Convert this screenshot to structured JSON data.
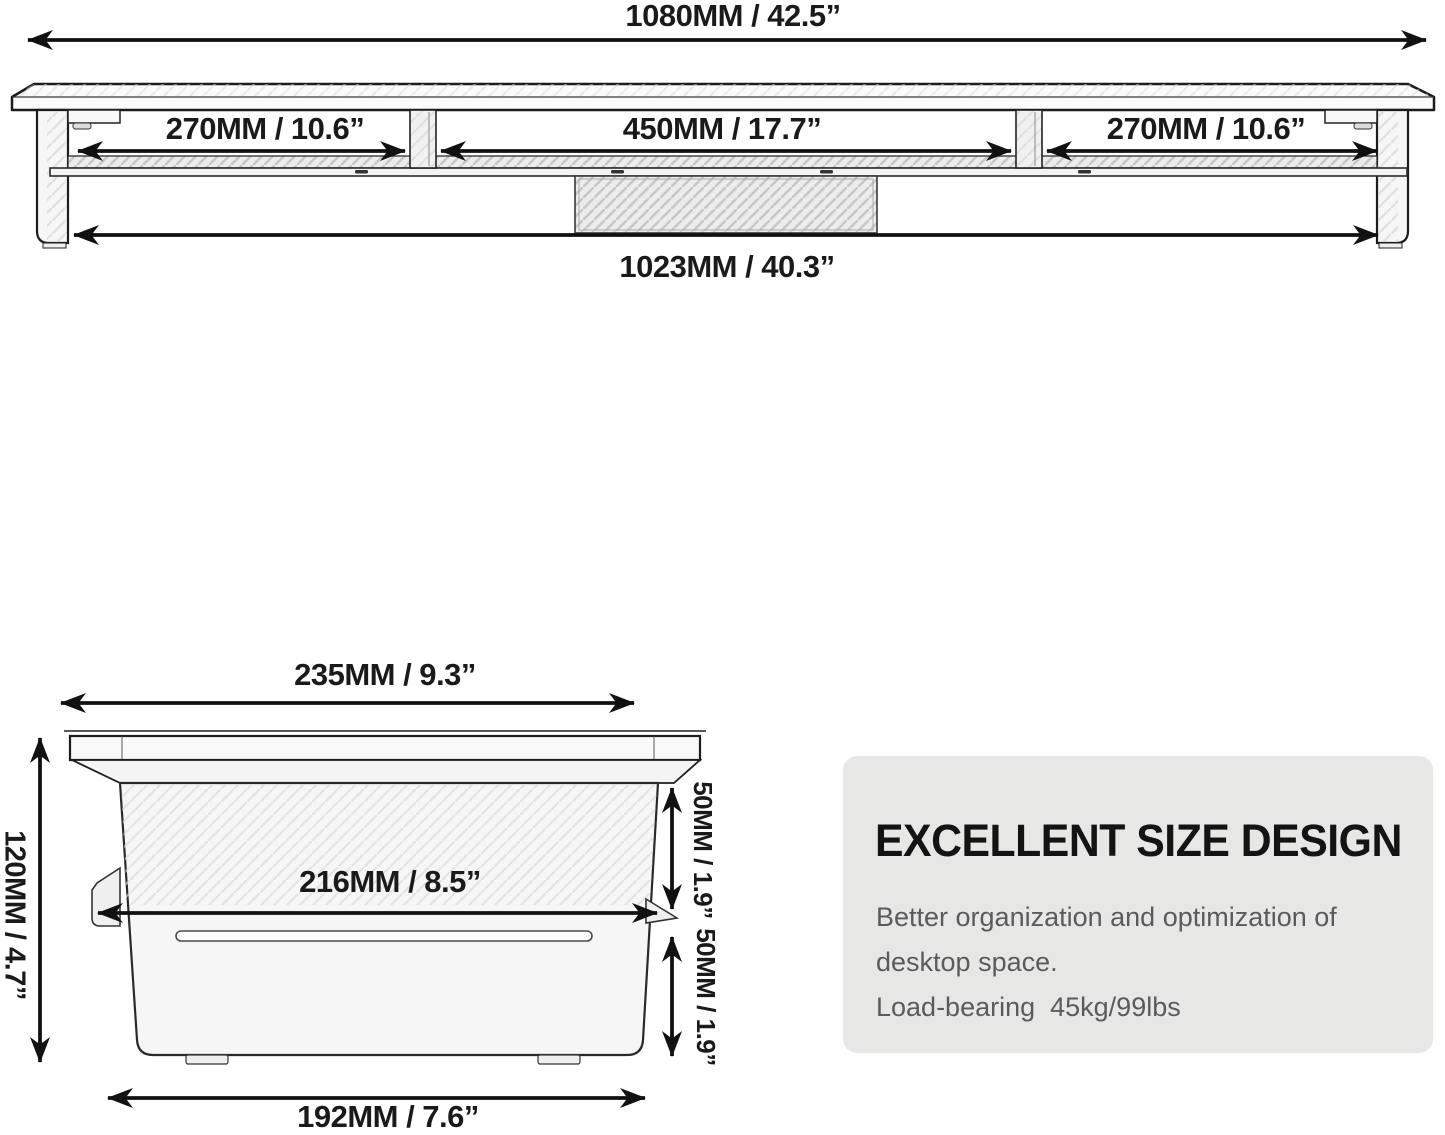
{
  "front_view": {
    "overall_width": "1080MM / 42.5”",
    "compartments": [
      {
        "label": "270MM / 10.6”"
      },
      {
        "label": "450MM / 17.7”"
      },
      {
        "label": "270MM / 10.6”"
      }
    ],
    "inner_width": "1023MM / 40.3”"
  },
  "side_view": {
    "top_depth": "235MM / 9.3”",
    "overall_height": "120MM / 4.7”",
    "shelf_depth": "216MM / 8.5”",
    "upper_gap": "50MM / 1.9”",
    "lower_gap": "50MM / 1.9”",
    "base_depth": "192MM / 7.6”"
  },
  "info_box": {
    "title": "EXCELLENT SIZE DESIGN",
    "lines": [
      "Better organization and optimization of",
      "desktop space.",
      "Load-bearing  45kg/99lbs"
    ]
  },
  "colors": {
    "background": "#ffffff",
    "line": "#1a1a1a",
    "panel_bg": "#e7e7e6",
    "panel_title": "#141414",
    "panel_body": "#5b5b5d"
  }
}
